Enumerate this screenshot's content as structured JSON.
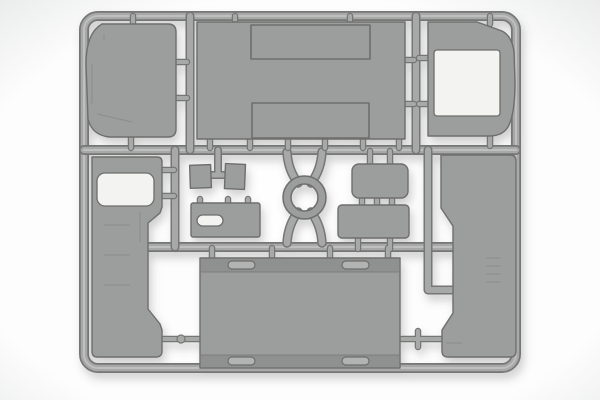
{
  "meta": {
    "description": "Product photograph of a light-gray injection-molded plastic model kit sprue holding flat body panels, hatches, a circular ring and small fittings on a runner frame",
    "scene_type": "sprue-photo"
  },
  "colors": {
    "bg_center": "#fdfdfd",
    "bg_edge": "#e7e8e8",
    "bloom": "#ffffff",
    "runner_fill": "#a7a8a8",
    "runner_highlight": "#c6c7c6",
    "runner_edge": "#767674",
    "part_fill": "#9c9d9d",
    "part_edge": "#6e6e6c",
    "part_dark": "#8f9090",
    "detail_light": "#b2b3b3",
    "opening_fill": "#f3f3f2",
    "shadow_color": "#5a5a58"
  },
  "parts": {
    "top_left_panel": "rounded-corner-panel",
    "top_center_panel": "large-panel-with-two-raised-hatches",
    "top_right_panel": "panel-with-square-window-opening",
    "left_side_panel": "tall-side-panel-with-window-opening",
    "right_side_panel": "tall-stepped-side-panel",
    "bottom_panel": "large-flat-panel-with-four-handle-recesses",
    "center_ring": "circular-ring",
    "small_parts": [
      "small-block-a",
      "small-block-b",
      "plate-with-slot-opening",
      "rounded-plate-upper",
      "rounded-plate-lower"
    ]
  }
}
